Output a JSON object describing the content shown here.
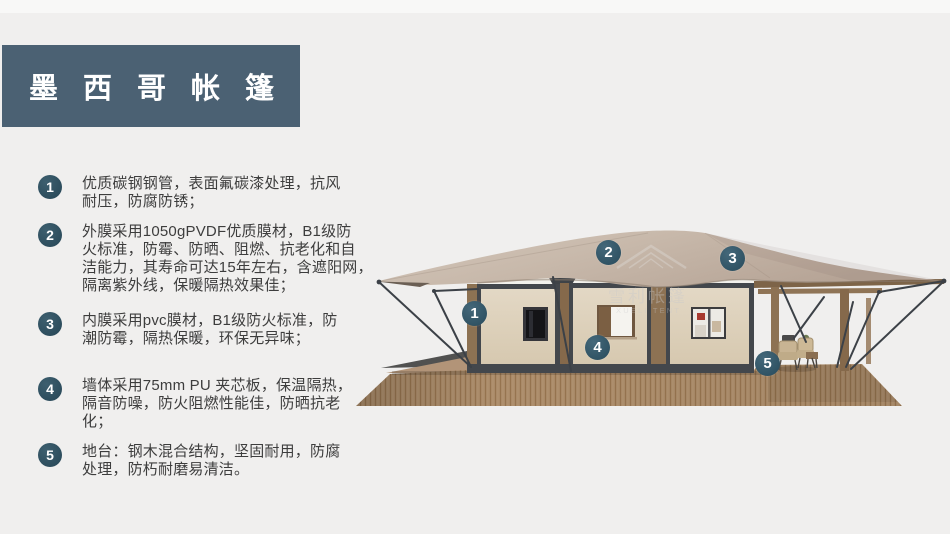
{
  "title": "墨西哥帐篷",
  "features": [
    {
      "num": "1",
      "text": "优质碳钢钢管，表面氟碳漆处理，抗风耐压，防腐防锈；",
      "lines": [
        "优质碳钢钢管，表面氟碳漆处理，抗风",
        "耐压，防腐防锈；"
      ]
    },
    {
      "num": "2",
      "text": "外膜采用1050gPVDF优质膜材，B1级防火标准，防霉、防晒、阻燃、抗老化和自洁能力，其寿命可达15年左右，含遮阳网，隔离紫外线，保暖隔热效果佳；",
      "lines": [
        "外膜采用1050gPVDF优质膜材，B1级防",
        "火标准，防霉、防晒、阻燃、抗老化和自",
        "洁能力，其寿命可达15年左右，含遮阳网，",
        "隔离紫外线，保暖隔热效果佳；"
      ]
    },
    {
      "num": "3",
      "text": "内膜采用pvc膜材，B1级防火标准，防潮防霉，隔热保暖，环保无异味；",
      "lines": [
        "内膜采用pvc膜材，B1级防火标准，防",
        "潮防霉，隔热保暖，环保无异味；"
      ]
    },
    {
      "num": "4",
      "text": "墙体采用75mm PU 夹芯板，保温隔热，隔音防噪，防火阻燃性能佳，防晒抗老化；",
      "lines": [
        "墙体采用75mm PU 夹芯板，保温隔热，",
        "隔音防噪，防火阻燃性能佳，防晒抗老",
        "化；"
      ]
    },
    {
      "num": "5",
      "text": "地台：钢木混合结构，坚固耐用，防腐处理，防朽耐磨易清洁。",
      "lines": [
        "地台：钢木混合结构，坚固耐用，防腐",
        "处理，防朽耐磨易清洁。"
      ]
    }
  ],
  "callouts": [
    {
      "num": "1"
    },
    {
      "num": "2"
    },
    {
      "num": "3"
    },
    {
      "num": "4"
    },
    {
      "num": "5"
    }
  ],
  "watermark": {
    "cn": "雪利帐篷",
    "en": "XUELI TENT"
  },
  "colors": {
    "background": "#f0efee",
    "banner": "#4b6173",
    "list_badge": "#2e4e5d",
    "image_badge": "#34576a",
    "text": "#3d3d3d",
    "roof_membrane": "#c8b9ab",
    "wall_panel": "#ded3c0",
    "wall_frame": "#43474c",
    "wood_post": "#8d7253",
    "deck_wood": "#aa8a68",
    "cable": "#3c4147"
  }
}
